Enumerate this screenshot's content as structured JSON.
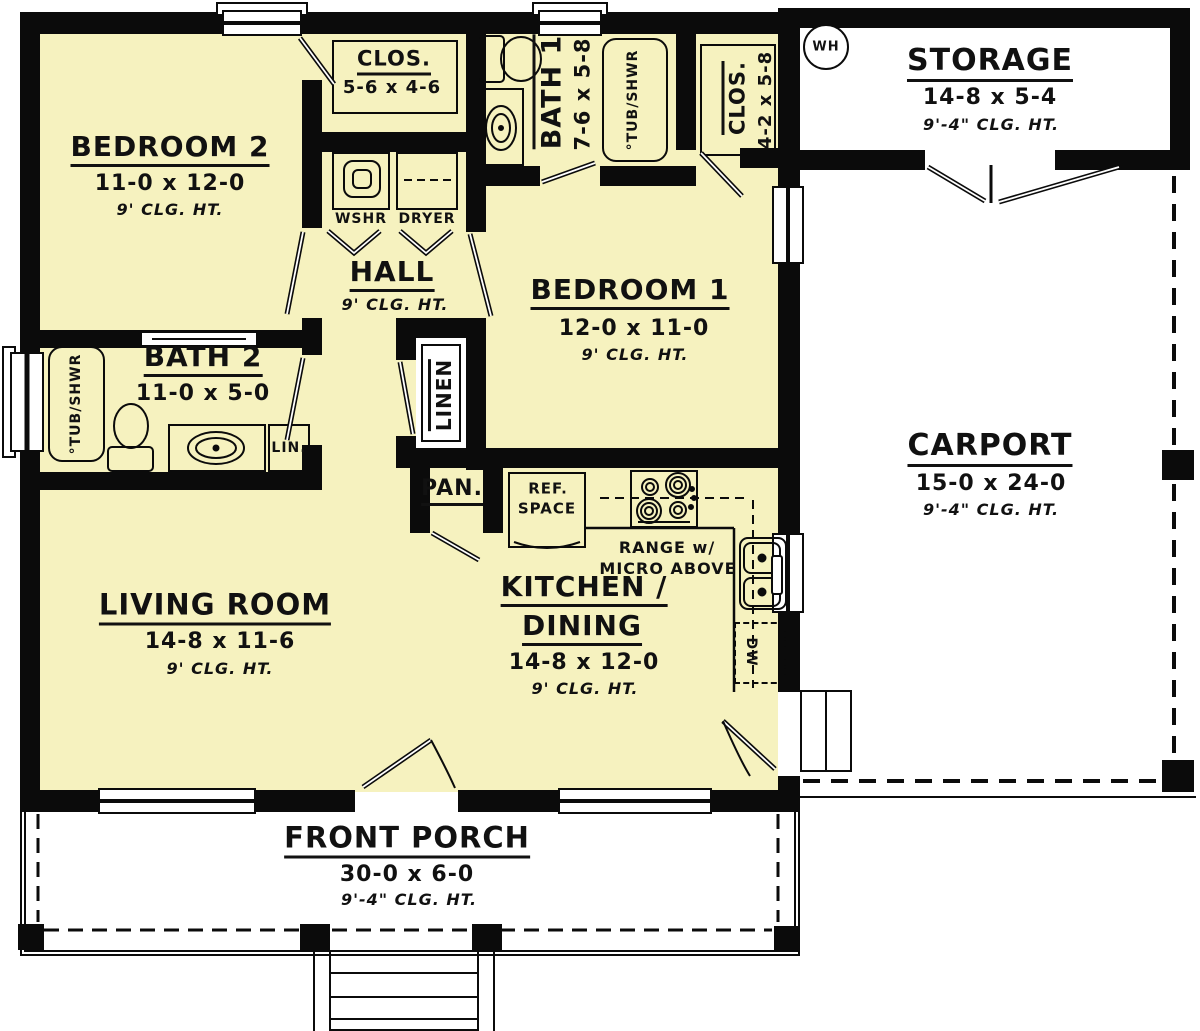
{
  "plan": {
    "bedroom2": {
      "name": "BEDROOM 2",
      "dims": "11-0 x 12-0",
      "clg": "9' CLG. HT."
    },
    "closet2": {
      "name": "CLOS.",
      "dims": "5-6 x 4-6"
    },
    "bath1": {
      "name": "BATH 1",
      "dims": "7-6 x 5-8",
      "tub": "°TUB/SHWR"
    },
    "closet1": {
      "name": "CLOS.",
      "dims": "4-2 x 5-8"
    },
    "storage": {
      "name": "STORAGE",
      "dims": "14-8 x 5-4",
      "clg": "9'-4\" CLG. HT.",
      "water_heater": "WH"
    },
    "laundry": {
      "washer": "WSHR",
      "dryer": "DRYER"
    },
    "hall": {
      "name": "HALL",
      "clg": "9' CLG. HT."
    },
    "bedroom1": {
      "name": "BEDROOM 1",
      "dims": "12-0 x 11-0",
      "clg": "9' CLG. HT."
    },
    "bath2": {
      "name": "BATH 2",
      "dims": "11-0 x 5-0",
      "tub": "°TUB/SHWR",
      "linen_cabinet": "LIN."
    },
    "linen": {
      "name": "LINEN"
    },
    "pantry": {
      "name": "PAN."
    },
    "kitchen": {
      "name_line1": "KITCHEN /",
      "name_line2": "DINING",
      "dims": "14-8 x 12-0",
      "clg": "9' CLG. HT.",
      "ref_line1": "REF.",
      "ref_line2": "SPACE",
      "range_line1": "RANGE w/",
      "range_line2": "MICRO ABOVE",
      "dishwasher": "DW"
    },
    "living": {
      "name": "LIVING ROOM",
      "dims": "14-8 x 11-6",
      "clg": "9' CLG. HT."
    },
    "carport": {
      "name": "CARPORT",
      "dims": "15-0 x 24-0",
      "clg": "9'-4\" CLG. HT."
    },
    "porch": {
      "name": "FRONT PORCH",
      "dims": "30-0 x 6-0",
      "clg": "9'-4\" CLG. HT."
    }
  }
}
